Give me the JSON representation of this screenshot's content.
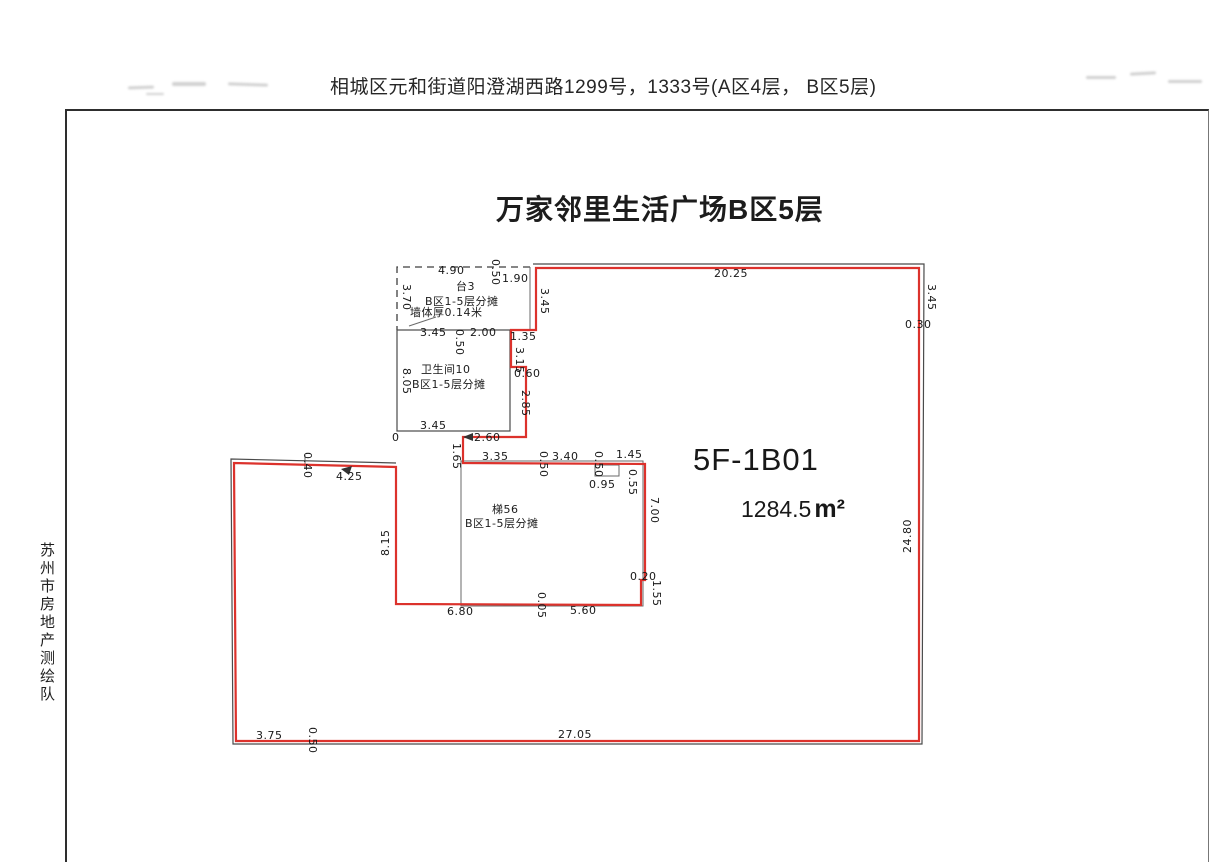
{
  "page": {
    "header_address": "相城区元和街道阳澄湖西路1299号，1333号(A区4层， B区5层)",
    "side_label": "苏州市房地产测绘队",
    "title": "万家邻里生活广场B区5层",
    "unit_id": "5F-1B01",
    "area_value": "1284.5",
    "area_unit": "m²"
  },
  "floorplan": {
    "outline_color": "#dc322c",
    "base_line_color": "#4a4a4a",
    "rooms": [
      {
        "name": "台3",
        "share_note": "B区1-5层分摊"
      },
      {
        "name": "卫生间10",
        "share_note": "B区1-5层分摊"
      },
      {
        "name": "梯56",
        "share_note": "B区1-5层分摊"
      }
    ],
    "wall_note": "墙体厚0.14米",
    "annotations": [
      {
        "t": "4.90",
        "x": 438,
        "y": 274
      },
      {
        "t": "0.50",
        "x": 492,
        "y": 259,
        "r": 90
      },
      {
        "t": "1.90",
        "x": 502,
        "y": 282
      },
      {
        "t": "3.70",
        "x": 403,
        "y": 284,
        "r": 90
      },
      {
        "t": "台3",
        "x": 456,
        "y": 290,
        "cls": "room"
      },
      {
        "t": "B区1-5层分摊",
        "x": 425,
        "y": 305,
        "cls": "room"
      },
      {
        "t": "墙体厚0.14米",
        "x": 410,
        "y": 316,
        "cls": "room"
      },
      {
        "t": "3.45",
        "x": 541,
        "y": 288,
        "r": 90
      },
      {
        "t": "3.45",
        "x": 420,
        "y": 336
      },
      {
        "t": "0.50",
        "x": 456,
        "y": 329,
        "r": 90
      },
      {
        "t": "2.00",
        "x": 470,
        "y": 336
      },
      {
        "t": "1.35",
        "x": 510,
        "y": 340
      },
      {
        "t": "3.15",
        "x": 516,
        "y": 347,
        "r": 90
      },
      {
        "t": "0.60",
        "x": 514,
        "y": 377
      },
      {
        "t": "2.85",
        "x": 522,
        "y": 390,
        "r": 90
      },
      {
        "t": "8.05",
        "x": 403,
        "y": 368,
        "r": 90
      },
      {
        "t": "卫生间10",
        "x": 421,
        "y": 373,
        "cls": "room"
      },
      {
        "t": "B区1-5层分摊",
        "x": 412,
        "y": 388,
        "cls": "room"
      },
      {
        "t": "3.45",
        "x": 420,
        "y": 429
      },
      {
        "t": "0",
        "x": 392,
        "y": 441
      },
      {
        "t": "2.60",
        "x": 474,
        "y": 441
      },
      {
        "t": "1.65",
        "x": 453,
        "y": 443,
        "r": 90
      },
      {
        "t": "3.35",
        "x": 482,
        "y": 460
      },
      {
        "t": "0.50",
        "x": 540,
        "y": 451,
        "r": 90
      },
      {
        "t": "3.40",
        "x": 552,
        "y": 460
      },
      {
        "t": "0.50",
        "x": 595,
        "y": 451,
        "r": 90
      },
      {
        "t": "1.45",
        "x": 616,
        "y": 458
      },
      {
        "t": "0.95",
        "x": 589,
        "y": 488
      },
      {
        "t": "0.55",
        "x": 629,
        "y": 469,
        "r": 90
      },
      {
        "t": "梯56",
        "x": 492,
        "y": 513,
        "cls": "room"
      },
      {
        "t": "B区1-5层分摊",
        "x": 465,
        "y": 527,
        "cls": "room"
      },
      {
        "t": "20.25",
        "x": 714,
        "y": 277
      },
      {
        "t": "3.45",
        "x": 928,
        "y": 284,
        "r": 90
      },
      {
        "t": "0.30",
        "x": 905,
        "y": 328
      },
      {
        "t": "24.80",
        "x": 911,
        "y": 553,
        "r": -90
      },
      {
        "t": "7.00",
        "x": 651,
        "y": 497,
        "r": 90
      },
      {
        "t": "0.20",
        "x": 630,
        "y": 580
      },
      {
        "t": "1.55",
        "x": 653,
        "y": 580,
        "r": 90
      },
      {
        "t": "6.80",
        "x": 447,
        "y": 615
      },
      {
        "t": "0.05",
        "x": 538,
        "y": 592,
        "r": 90
      },
      {
        "t": "5.60",
        "x": 570,
        "y": 614
      },
      {
        "t": "8.15",
        "x": 389,
        "y": 556,
        "r": -90
      },
      {
        "t": "4.25",
        "x": 336,
        "y": 480
      },
      {
        "t": "0.40",
        "x": 304,
        "y": 452,
        "r": 90
      },
      {
        "t": "3.75",
        "x": 256,
        "y": 739
      },
      {
        "t": "0.50",
        "x": 309,
        "y": 727,
        "r": 90
      },
      {
        "t": "27.05",
        "x": 558,
        "y": 738
      }
    ]
  }
}
